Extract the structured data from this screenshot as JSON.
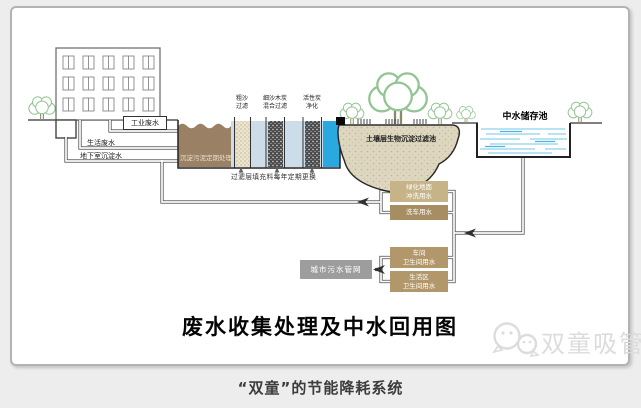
{
  "panel": {
    "title": "废水收集处理及中水回用图",
    "caption": "“双童”的节能降耗系统",
    "watermark": "双童吸管"
  },
  "sources": {
    "industrial": "工业废水",
    "domestic": "生活废水",
    "basement": "地下室沉淀水"
  },
  "treatment": {
    "sedimentation_note": "沉淀污泥定期处理",
    "filters": [
      {
        "line1": "粗沙",
        "line2": "过滤"
      },
      {
        "line1": "细沙木炭",
        "line2": "混合过滤"
      },
      {
        "line1": "活性炭",
        "line2": "净化"
      }
    ],
    "filter_note": "过滤层填充料每年定期更换",
    "soil_pool": "土壤层生物沉淀过滤池",
    "storage_pool": "中水储存池"
  },
  "reuse": {
    "boxes": [
      {
        "line1": "绿化地面",
        "line2": "冲洗用水"
      },
      {
        "line1": "洗车用水",
        "line2": ""
      },
      {
        "line1": "车间",
        "line2": "卫生间用水"
      },
      {
        "line1": "生活区",
        "line2": "卫生间用水"
      }
    ],
    "sewer": "城市污水管网"
  },
  "colors": {
    "sediment_tank": "#9a8165",
    "filter_water": "#ccdce8",
    "sand_column": "#ece5cf",
    "charcoal_column": "#4b4b4b",
    "clean_water": "#2aa9e0",
    "soil_pool": "#ded7c0",
    "storage_water_lines": "#8fd2ea",
    "reuse_box_light": "#c6b488",
    "reuse_box_dark": "#a78e62",
    "reuse_box_mid": "#b2976b",
    "sewer_box": "#9d9d9d",
    "tree_green": "#93c493",
    "watermark_gray": "#dcdcdc"
  }
}
